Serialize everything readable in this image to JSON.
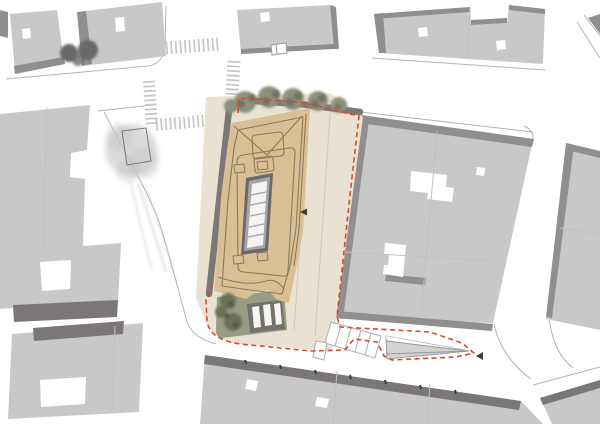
{
  "canvas": {
    "width": 600,
    "height": 424,
    "background": "#ffffff"
  },
  "features": {
    "plan_type": "urban-site-plan",
    "central_building": "topographic-roof-with-skylight-core",
    "boundary_style": "red-dashed",
    "top_tree_row_count": 5,
    "crosswalk_count": 4,
    "stair_runs": 1,
    "ramp": "triangular",
    "garden": "roof-garden-with-grate"
  },
  "palette": {
    "bg": "#ffffff",
    "block_fill": "#c8c8c9",
    "block_edge": "#908e8f",
    "facade_dark": "#7b7779",
    "courtyard": "#ffffff",
    "curb": "#b5b3b1",
    "lot_line": "#c3c1bf",
    "crosswalk": "#c6c5c4",
    "plaza": "#e9e1d2",
    "plaza_joint": "#d0c7b4",
    "site_wall": "#7b7875",
    "roof_tan": "#d9bf94",
    "roof_contour": "#8c7a5c",
    "core_dark": "#6b696b",
    "core_mid": "#a8a6a7",
    "core_panel": "#f4f4f3",
    "garden": "#999c82",
    "grate_frame": "#73716b",
    "grate_bar": "#f5f5f3",
    "stair_fill": "#fdfdfd",
    "stair_line": "#b1afad",
    "ramp_fill": "#d4d2d0",
    "ramp_line": "#9b9997",
    "ramp_facet": "#ffffff",
    "boundary_red": "#d8492d",
    "arrow": "#3f3d3e",
    "tree_gray": "#c4c4c4",
    "tree_charcoal": "#696969",
    "tree_sage": "#8d907c",
    "tree_sage_dark": "#6f7360",
    "tree_olive": "#6d7158",
    "tree_olive_dark": "#565a45",
    "planter": "#7b7977",
    "vehicle_line": "#9a9896"
  }
}
